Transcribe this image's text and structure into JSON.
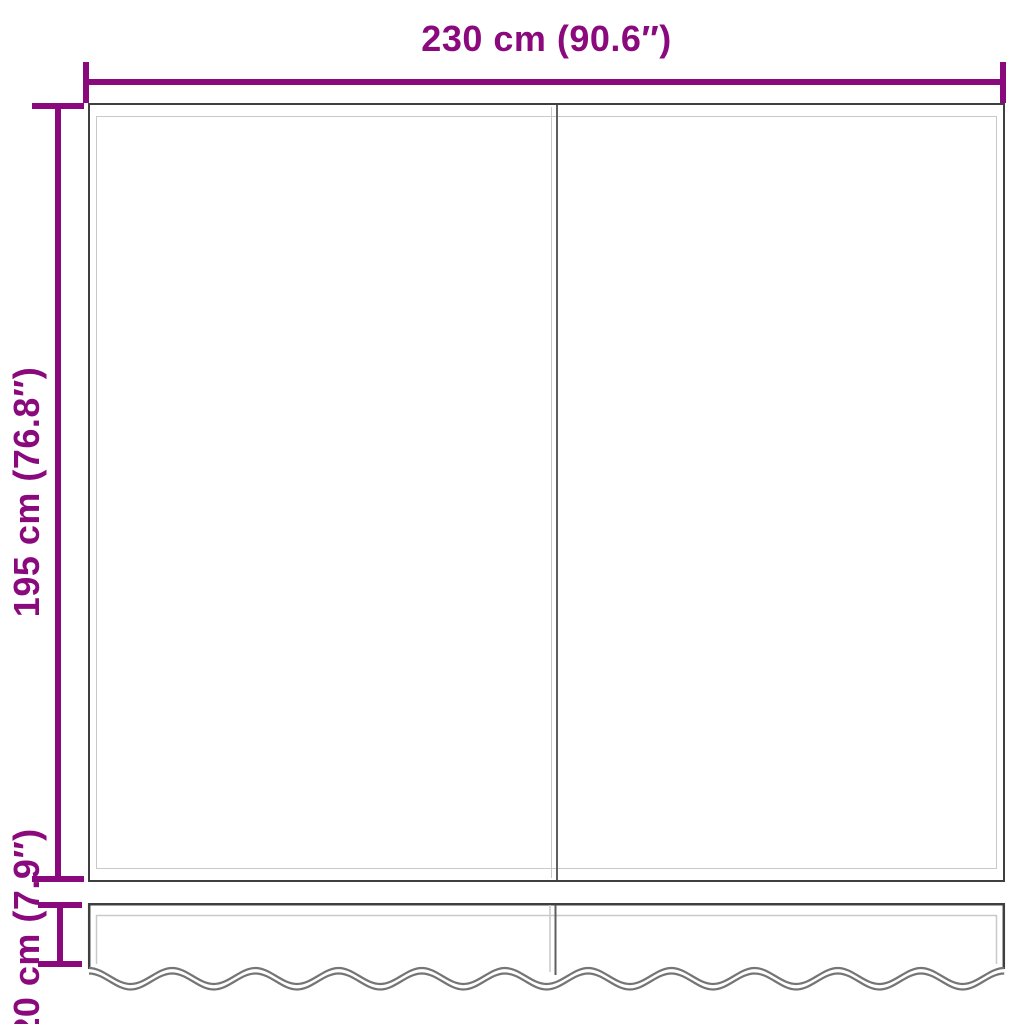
{
  "diagram": {
    "width_label": "230 cm (90.6″)",
    "height_label": "195 cm (76.8″)",
    "valance_label": "20 cm (7.9″)"
  },
  "colors": {
    "dimension": "#8a0a7e",
    "outline": "#3f3f3f",
    "hem": "#c9c9c9",
    "seam": "#5f5f5f",
    "wave": "#757575",
    "background": "#ffffff"
  }
}
